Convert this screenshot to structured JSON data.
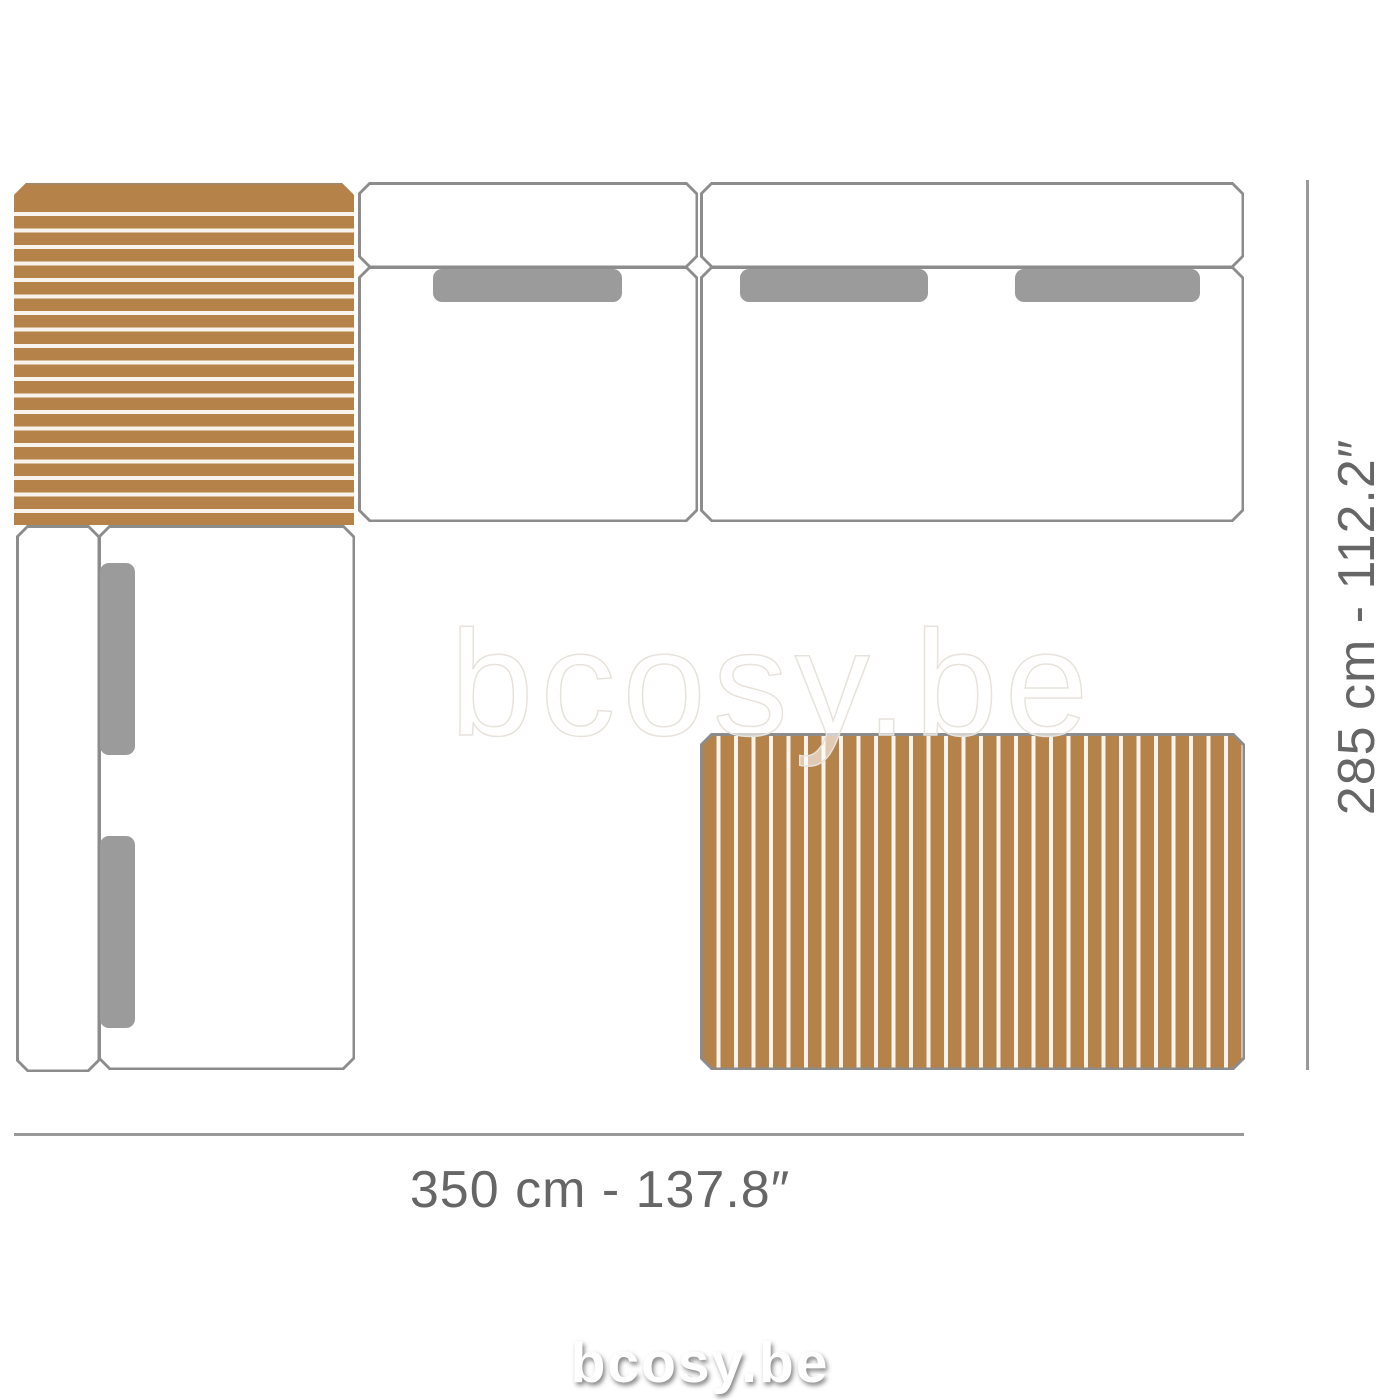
{
  "labels": {
    "width": "350 cm - 137.8″",
    "height": "285 cm - 112.2″"
  },
  "watermarks": {
    "center": "bcosy.be",
    "bottom": "bcosy.be"
  },
  "colors": {
    "background": "#ffffff",
    "wood": "#b5824a",
    "slat_gap": "#f8f4ed",
    "outline": "#8c8c8c",
    "fill": "#ffffff",
    "cushion": "#9b9b9b",
    "dim_line": "#999999",
    "dim_text": "#666666",
    "watermark_stroke": "#e7e2db"
  }
}
